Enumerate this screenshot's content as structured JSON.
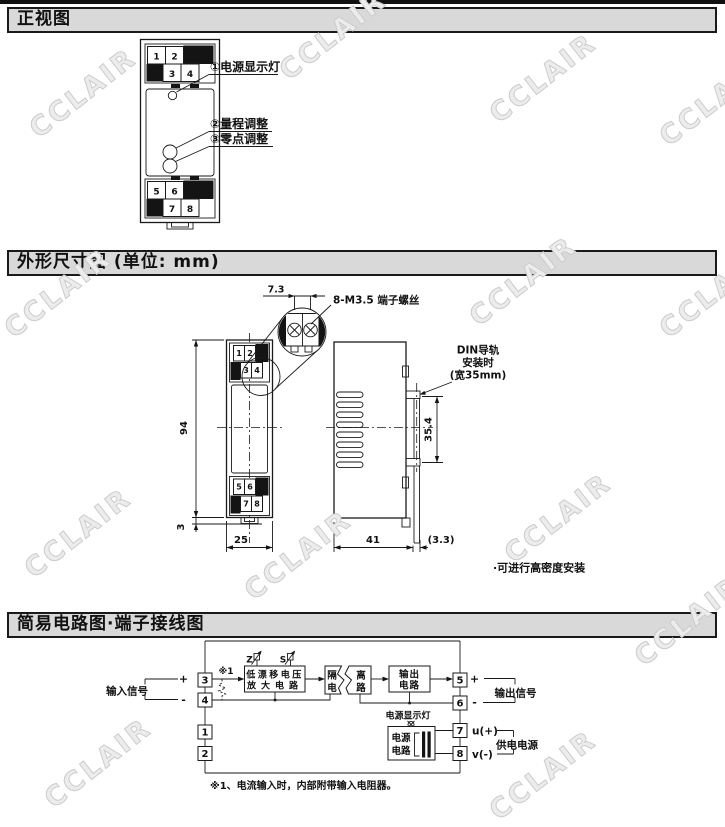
{
  "watermark": {
    "text": "CCLAIR"
  },
  "sections": {
    "front_view": {
      "title": "正视图",
      "terminals": [
        "1",
        "2",
        "3",
        "4",
        "5",
        "6",
        "7",
        "8"
      ],
      "callout1": "①电源显示灯",
      "callout2": "②量程调整",
      "callout3": "③零点调整"
    },
    "outline": {
      "title": "外形尺寸图 (单位: mm)",
      "terminals": [
        "1",
        "2",
        "3",
        "4",
        "5",
        "6",
        "7",
        "8"
      ],
      "dim_7_3": "7.3",
      "screw_label": "8-M3.5 端子螺丝",
      "din_line1": "DIN导轨",
      "din_line2": "安装时",
      "din_line3": "(宽35mm)",
      "dim_94": "94",
      "dim_35_4": "35.4",
      "dim_3": "3",
      "dim_25": "25",
      "dim_41": "41",
      "dim_3_3": "(3.3)",
      "note": "·可进行高密度安装"
    },
    "circuit": {
      "title": "简易电路图·端子接线图",
      "input_label": "输入信号",
      "output_label": "输出信号",
      "supply_label": "供电电源",
      "plus": "+",
      "minus": "-",
      "ref": "※1",
      "trimmer_z": "Z",
      "trimmer_s": "S",
      "amp_line1": "低漂移电压",
      "amp_line2": "放大电路",
      "iso_left_top": "隔",
      "iso_left_bottom": "电",
      "iso_right_top": "离",
      "iso_right_bottom": "路",
      "out_line1": "输出",
      "out_line2": "电路",
      "lamp_label": "电源显示灯",
      "psu_line1": "电源",
      "psu_line2": "电路",
      "u_label": "u(+)",
      "v_label": "v(-)",
      "terminals": {
        "t1": "1",
        "t2": "2",
        "t3": "3",
        "t4": "4",
        "t5": "5",
        "t6": "6",
        "t7": "7",
        "t8": "8"
      },
      "note": "※1、电流输入时，内部附带输入电阻器。"
    }
  }
}
